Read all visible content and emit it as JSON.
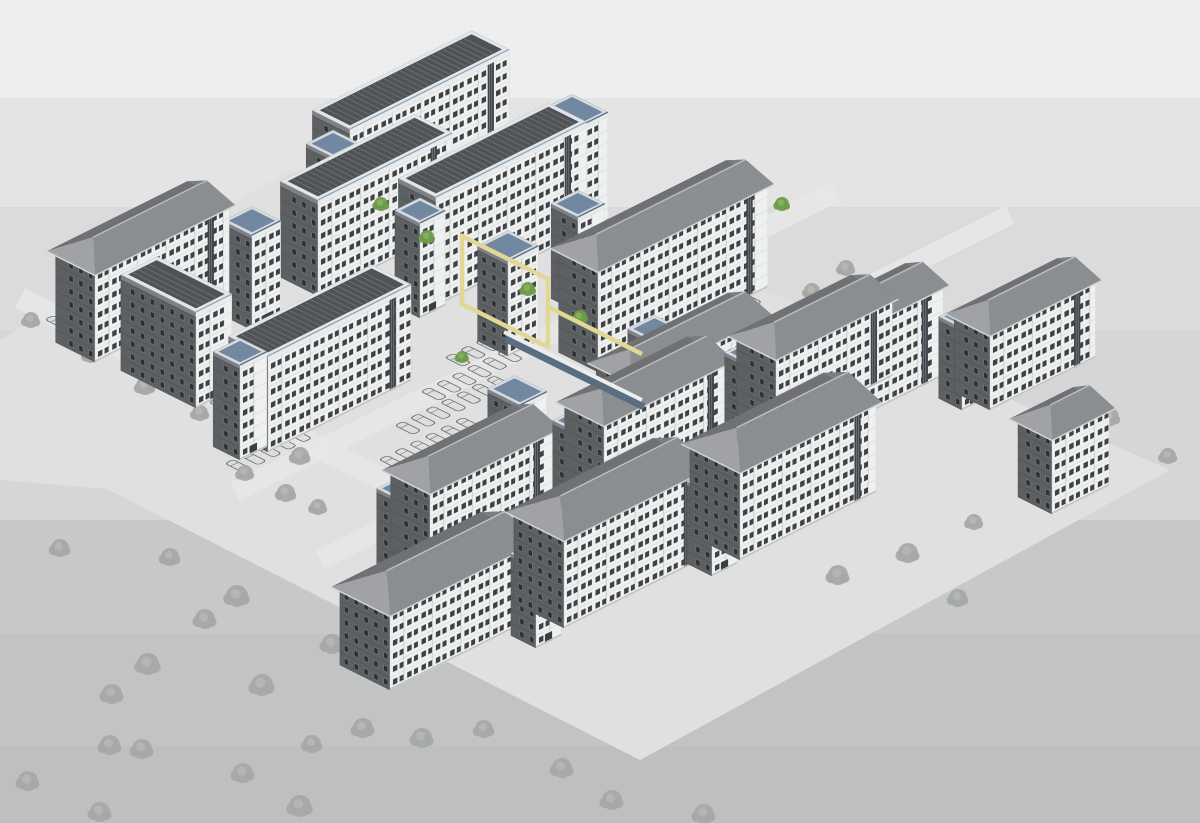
{
  "meta": {
    "description": "3D axonometric architectural model view of a residential apartment complex with parking lots and trees",
    "view_type": "axonometric-3d-model"
  },
  "palette": {
    "band_colors": [
      "#EDEEED",
      "#E3E4E3",
      "#DADBDA",
      "#D5D6D5",
      "#C7C9C8",
      "#C2C4C3",
      "#BEC0BF"
    ],
    "plaza": "#DFE0DF",
    "road": "#E7E8E7",
    "se_wall": "#EFF0F0",
    "se_wall_stroke": "#D6D8D8",
    "se_floorline": "#DFE1E1",
    "se_window": "#3E4246",
    "se_window_frame": "#FBFBFB",
    "se_recess": "#CED1D2",
    "se_stair_glass": "#41454A",
    "se_stair_mullion": "#9AA0A4",
    "se_base": "#C2C4C4",
    "se_parapet": "#E9EBEC",
    "sw_wall": "#5D6063",
    "sw_wall_stroke": "#4E5154",
    "sw_floorline": "#525558",
    "sw_window": "#2C2E30",
    "sw_window_frame": "#84878A",
    "sw_parapet": "#7D8084",
    "roof_se_slope": "#8B8E91",
    "roof_sw_hip": "#A0A2A5",
    "roof_nw_slope": "#6F7174",
    "roof_ne_hip": "#7B7D80",
    "roof_eave": "#D2D3D4",
    "roof_ridge": "#B9BBBE",
    "deck_rim": "#E3E6E9",
    "deck_rim_stroke": "#C8CCD0",
    "deck_face": "#505356",
    "deck_stripe": "#6B6E71",
    "deck_blue_accent": "#8FA6BD",
    "blue_rim": "#D7DCE1",
    "blue_rim_stroke": "#B8BFC6",
    "blue_face": "#7288A1",
    "blue_edge": "#5A7086",
    "door": "#394042",
    "tree_gray": "#A6A9A6",
    "tree_gray_light": "#B4B7B4",
    "tree_green": "#6E9B49",
    "tree_green_light": "#86B35E",
    "car_stroke": "#6B6D6D",
    "car_fill": "#D9DBDA",
    "portal_yellow": "#E0D894",
    "walkway_fascia": "#ECEDED",
    "walkway_glass": "#5B6E80"
  },
  "iso": {
    "d1": [
      0.894,
      -0.447
    ],
    "d2": [
      -0.894,
      -0.447
    ],
    "floor_height": 13,
    "gable_rise": 15,
    "overhang": 5
  },
  "canvas": {
    "width": 1200,
    "height": 823
  },
  "bands": [
    {
      "y0": 0,
      "y1": 98
    },
    {
      "y0": 98,
      "y1": 207
    },
    {
      "y0": 207,
      "y1": 330
    },
    {
      "y0": 330,
      "y1": 520
    },
    {
      "y0": 520,
      "y1": 634
    },
    {
      "y0": 634,
      "y1": 746
    },
    {
      "y0": 746,
      "y1": 823
    }
  ],
  "plazas": [
    {
      "points": [
        [
          70,
          470
        ],
        [
          540,
          190
        ],
        [
          1170,
          470
        ],
        [
          640,
          760
        ]
      ]
    },
    {
      "points": [
        [
          0,
          340
        ],
        [
          290,
          170
        ],
        [
          560,
          290
        ],
        [
          240,
          500
        ],
        [
          0,
          480
        ]
      ]
    }
  ],
  "roads": [
    {
      "from": [
        20,
        298
      ],
      "to": [
        392,
        484
      ],
      "width": 22
    },
    {
      "from": [
        235,
        492
      ],
      "to": [
        836,
        192
      ],
      "width": 20
    },
    {
      "from": [
        320,
        560
      ],
      "to": [
        1010,
        215
      ],
      "width": 20
    }
  ],
  "buildings": [
    {
      "id": "M1",
      "x": 350,
      "y": 238,
      "len": 178,
      "dep": 42,
      "fl": 8,
      "roof": "deck"
    },
    {
      "id": "Mt1",
      "x": 333,
      "y": 252,
      "len": 30,
      "dep": 30,
      "fl": 7,
      "roof": "blue"
    },
    {
      "id": "Mt2",
      "x": 556,
      "y": 246,
      "len": 58,
      "dep": 40,
      "fl": 8,
      "roof": "blue"
    },
    {
      "id": "B1",
      "x": 318,
      "y": 296,
      "len": 150,
      "dep": 42,
      "fl": 7,
      "roof": "deck"
    },
    {
      "id": "M2",
      "x": 436,
      "y": 306,
      "len": 168,
      "dep": 42,
      "fl": 8,
      "roof": "deck"
    },
    {
      "id": "Mt3",
      "x": 420,
      "y": 318,
      "len": 28,
      "dep": 28,
      "fl": 7,
      "roof": "blue"
    },
    {
      "id": "At1",
      "x": 252,
      "y": 330,
      "len": 32,
      "dep": 32,
      "fl": 7,
      "roof": "blue"
    },
    {
      "id": "A1",
      "x": 95,
      "y": 362,
      "len": 150,
      "dep": 44,
      "fl": 7,
      "roof": "gable"
    },
    {
      "id": "W1",
      "x": 196,
      "y": 408,
      "len": 40,
      "dep": 84,
      "fl": 7,
      "roof": "deck"
    },
    {
      "id": "Mt4",
      "x": 508,
      "y": 356,
      "len": 34,
      "dep": 34,
      "fl": 7,
      "roof": "blue"
    },
    {
      "id": "Mt5",
      "x": 578,
      "y": 312,
      "len": 30,
      "dep": 30,
      "fl": 7,
      "roof": "blue"
    },
    {
      "id": "M3",
      "x": 598,
      "y": 372,
      "len": 190,
      "dep": 44,
      "fl": 8,
      "roof": "gable"
    },
    {
      "id": "C1",
      "x": 268,
      "y": 452,
      "len": 160,
      "dep": 44,
      "fl": 7,
      "roof": "deck"
    },
    {
      "id": "At2",
      "x": 240,
      "y": 460,
      "len": 30,
      "dep": 30,
      "fl": 7,
      "roof": "blue"
    },
    {
      "id": "TH2",
      "x": 660,
      "y": 414,
      "len": 30,
      "dep": 36,
      "fl": 5,
      "roof": "blue"
    },
    {
      "id": "TH1",
      "x": 520,
      "y": 474,
      "len": 30,
      "dep": 36,
      "fl": 5,
      "roof": "blue"
    },
    {
      "id": "R1",
      "x": 632,
      "y": 472,
      "len": 150,
      "dep": 40,
      "fl": 7,
      "roof": "gable"
    },
    {
      "id": "Rt1",
      "x": 790,
      "y": 446,
      "len": 26,
      "dep": 26,
      "fl": 6,
      "roof": "blue"
    },
    {
      "id": "R2",
      "x": 818,
      "y": 438,
      "len": 140,
      "dep": 40,
      "fl": 7,
      "roof": "gable"
    },
    {
      "id": "Rt2",
      "x": 962,
      "y": 410,
      "len": 26,
      "dep": 26,
      "fl": 6,
      "roof": "blue"
    },
    {
      "id": "R3",
      "x": 990,
      "y": 410,
      "len": 118,
      "dep": 40,
      "fl": 6,
      "roof": "gable"
    },
    {
      "id": "TG1",
      "x": 400,
      "y": 582,
      "len": 26,
      "dep": 26,
      "fl": 6,
      "roof": "blue"
    },
    {
      "id": "G1",
      "x": 430,
      "y": 568,
      "len": 140,
      "dep": 44,
      "fl": 6,
      "roof": "gable"
    },
    {
      "id": "TG2",
      "x": 576,
      "y": 514,
      "len": 26,
      "dep": 26,
      "fl": 6,
      "roof": "blue"
    },
    {
      "id": "G2",
      "x": 604,
      "y": 500,
      "len": 140,
      "dep": 44,
      "fl": 6,
      "roof": "gable"
    },
    {
      "id": "TG3",
      "x": 748,
      "y": 446,
      "len": 26,
      "dep": 26,
      "fl": 6,
      "roof": "blue"
    },
    {
      "id": "G3",
      "x": 776,
      "y": 434,
      "len": 130,
      "dep": 44,
      "fl": 6,
      "roof": "gable"
    },
    {
      "id": "F4",
      "x": 1052,
      "y": 514,
      "len": 64,
      "dep": 38,
      "fl": 6,
      "roof": "gable"
    },
    {
      "id": "F1",
      "x": 390,
      "y": 690,
      "len": 160,
      "dep": 56,
      "fl": 6,
      "roof": "gable"
    },
    {
      "id": "Tf1",
      "x": 536,
      "y": 648,
      "len": 28,
      "dep": 28,
      "fl": 6,
      "roof": "blue"
    },
    {
      "id": "F2",
      "x": 564,
      "y": 628,
      "len": 158,
      "dep": 56,
      "fl": 7,
      "roof": "gable"
    },
    {
      "id": "Tf2",
      "x": 712,
      "y": 576,
      "len": 28,
      "dep": 28,
      "fl": 6,
      "roof": "blue"
    },
    {
      "id": "F3",
      "x": 740,
      "y": 560,
      "len": 152,
      "dep": 56,
      "fl": 7,
      "roof": "gable"
    }
  ],
  "portal": {
    "width": 4.5,
    "segments": [
      [
        [
          462,
          236
        ],
        [
          462,
          304
        ]
      ],
      [
        [
          462,
          236
        ],
        [
          548,
          279
        ]
      ],
      [
        [
          548,
          279
        ],
        [
          548,
          343
        ]
      ],
      [
        [
          462,
          304
        ],
        [
          548,
          347
        ]
      ],
      [
        [
          548,
          307
        ],
        [
          640,
          353
        ]
      ]
    ]
  },
  "walkway": {
    "fascia": {
      "from": [
        504,
        332
      ],
      "to": [
        642,
        400
      ],
      "width": 4
    },
    "glass": {
      "from": [
        506,
        339
      ],
      "to": [
        644,
        407
      ],
      "width": 7
    }
  },
  "trees": {
    "gray": [
      [
        31,
        320,
        8
      ],
      [
        93,
        295,
        8
      ],
      [
        128,
        331,
        9
      ],
      [
        91,
        355,
        8
      ],
      [
        145,
        386,
        9
      ],
      [
        190,
        368,
        8
      ],
      [
        231,
        393,
        9
      ],
      [
        200,
        413,
        8
      ],
      [
        248,
        441,
        9
      ],
      [
        273,
        420,
        8
      ],
      [
        300,
        456,
        9
      ],
      [
        245,
        473,
        8
      ],
      [
        286,
        493,
        9
      ],
      [
        318,
        507,
        8
      ],
      [
        237,
        596,
        11
      ],
      [
        205,
        619,
        10
      ],
      [
        148,
        664,
        11
      ],
      [
        112,
        694,
        10
      ],
      [
        332,
        644,
        10
      ],
      [
        262,
        685,
        11
      ],
      [
        142,
        749,
        10
      ],
      [
        110,
        745,
        10
      ],
      [
        28,
        781,
        10
      ],
      [
        100,
        812,
        10
      ],
      [
        243,
        773,
        10
      ],
      [
        312,
        744,
        9
      ],
      [
        300,
        806,
        11
      ],
      [
        363,
        728,
        10
      ],
      [
        170,
        557,
        9
      ],
      [
        60,
        548,
        9
      ],
      [
        422,
        738,
        10
      ],
      [
        484,
        729,
        9
      ],
      [
        562,
        768,
        10
      ],
      [
        612,
        800,
        10
      ],
      [
        704,
        814,
        10
      ],
      [
        838,
        575,
        10
      ],
      [
        908,
        553,
        10
      ],
      [
        958,
        598,
        9
      ],
      [
        974,
        522,
        8
      ],
      [
        1047,
        500,
        9
      ],
      [
        1110,
        417,
        9
      ],
      [
        1168,
        456,
        8
      ],
      [
        846,
        268,
        8
      ],
      [
        812,
        291,
        8
      ],
      [
        890,
        302,
        8
      ]
    ],
    "green": [
      [
        381,
        204,
        7
      ],
      [
        427,
        237,
        7
      ],
      [
        528,
        289,
        7
      ],
      [
        580,
        317,
        7
      ],
      [
        782,
        204,
        7
      ],
      [
        462,
        357,
        6
      ]
    ]
  },
  "parking": {
    "car": {
      "length": 20,
      "width": 9,
      "corner_radius": 3
    },
    "rows": [
      {
        "x": 238,
        "y": 466,
        "count": 5
      },
      {
        "x": 252,
        "y": 432,
        "count": 4
      },
      {
        "x": 392,
        "y": 462,
        "count": 6
      },
      {
        "x": 408,
        "y": 428,
        "count": 7
      },
      {
        "x": 434,
        "y": 394,
        "count": 6
      },
      {
        "x": 458,
        "y": 360,
        "count": 5
      },
      {
        "x": 600,
        "y": 392,
        "count": 7
      },
      {
        "x": 626,
        "y": 356,
        "count": 6
      },
      {
        "x": 688,
        "y": 330,
        "count": 5
      },
      {
        "x": 838,
        "y": 344,
        "count": 6
      },
      {
        "x": 1008,
        "y": 302,
        "count": 3
      }
    ],
    "row_step": 17,
    "road_cars": [
      [
        58,
        322
      ],
      [
        84,
        326
      ],
      [
        143,
        368
      ],
      [
        156,
        369
      ],
      [
        222,
        405
      ],
      [
        262,
        424
      ]
    ]
  }
}
